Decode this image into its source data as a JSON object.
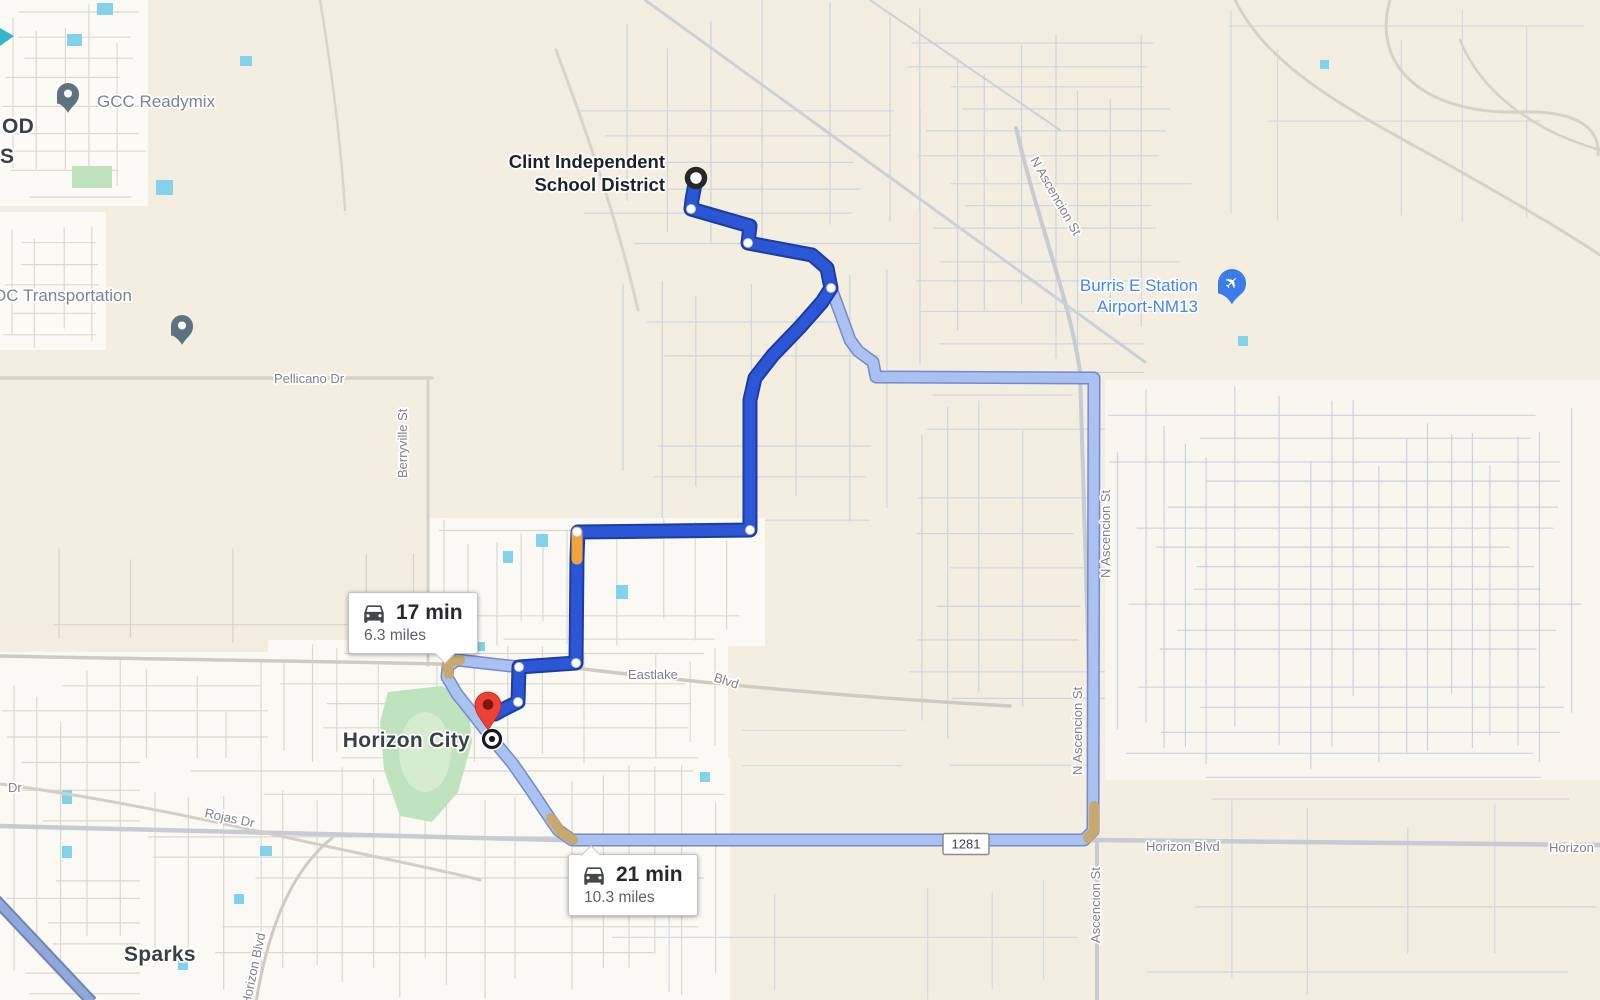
{
  "map": {
    "colors": {
      "bg": "#F3EEDF",
      "urban": "#FBFAF5",
      "urban2": "#F8F6EE",
      "minor_road": "#DCD8CE",
      "minor_road_blue": "#CDD5E2",
      "road_gray": "#C6CBD4",
      "road_warm": "#D6D2C8",
      "water": "#82D2EC",
      "water_dark": "#35B6CE",
      "park": "#BFE3BD",
      "park_light": "#D6ECCF",
      "primary_route": "#2B56D6",
      "primary_casing": "#1C3CA4",
      "alt_route": "#A9C2F2",
      "alt_casing": "#7589CE",
      "traffic_orange": "#F2A43A",
      "traffic_tan": "#C9A86E",
      "highway_blue": "#91A8DB",
      "highway_blue_casing": "#6F83B2",
      "poi_pin": "#5E7282",
      "airport_pin": "#3B7CE8",
      "dest_pin": "#EA4335",
      "dest_pin_dot": "#7E150F"
    }
  },
  "routes": {
    "primary": {
      "width": 11,
      "points": [
        [
          696,
          178
        ],
        [
          692,
          200
        ],
        [
          691,
          209
        ],
        [
          750,
          226
        ],
        [
          748,
          243
        ],
        [
          812,
          255
        ],
        [
          827,
          268
        ],
        [
          831,
          288
        ],
        [
          822,
          302
        ],
        [
          800,
          327
        ],
        [
          773,
          355
        ],
        [
          755,
          378
        ],
        [
          750,
          400
        ],
        [
          750,
          530
        ],
        [
          578,
          532
        ],
        [
          577,
          557
        ],
        [
          576,
          663
        ],
        [
          519,
          667
        ],
        [
          518,
          702
        ],
        [
          506,
          708
        ],
        [
          495,
          714
        ]
      ]
    },
    "alternate": {
      "width": 10,
      "points": [
        [
          519,
          667
        ],
        [
          457,
          660
        ],
        [
          448,
          666
        ],
        [
          447,
          677
        ],
        [
          457,
          694
        ],
        [
          473,
          714
        ],
        [
          493,
          740
        ],
        [
          513,
          764
        ],
        [
          531,
          790
        ],
        [
          547,
          814
        ],
        [
          558,
          830
        ],
        [
          572,
          840
        ],
        [
          1084,
          840
        ],
        [
          1093,
          831
        ],
        [
          1094,
          378
        ],
        [
          876,
          377
        ],
        [
          873,
          362
        ],
        [
          858,
          351
        ],
        [
          850,
          340
        ],
        [
          838,
          307
        ],
        [
          831,
          288
        ]
      ]
    },
    "traffic_orange_segments": [
      [
        [
          577,
          532
        ],
        [
          577,
          559
        ]
      ]
    ],
    "traffic_tan_segments": [
      [
        [
          449,
          674
        ],
        [
          447,
          666
        ],
        [
          452,
          661
        ],
        [
          460,
          660
        ]
      ],
      [
        [
          551,
          818
        ],
        [
          560,
          831
        ],
        [
          573,
          840
        ]
      ],
      [
        [
          1094,
          806
        ],
        [
          1094,
          831
        ],
        [
          1088,
          838
        ]
      ]
    ],
    "waypoints": [
      [
        691,
        209
      ],
      [
        748,
        243
      ],
      [
        831,
        288
      ],
      [
        750,
        530
      ],
      [
        577,
        532
      ],
      [
        576,
        663
      ],
      [
        519,
        667
      ],
      [
        518,
        702
      ]
    ]
  },
  "bubbles": {
    "primary": {
      "duration": "17 min",
      "distance": "6.3 miles",
      "x": 348,
      "y": 592,
      "pointer": "down"
    },
    "alternate": {
      "duration": "21 min",
      "distance": "10.3 miles",
      "x": 568,
      "y": 854,
      "pointer": "up"
    }
  },
  "shield": {
    "text": "1281",
    "x": 966,
    "y": 844
  },
  "markers": {
    "start": {
      "x": 696,
      "y": 178
    },
    "destination": {
      "x": 488,
      "y": 705
    },
    "destination_dot": {
      "x": 492,
      "y": 739
    },
    "pois": [
      {
        "id": "gcc-readymix-pin",
        "x": 68,
        "y": 94,
        "glyph": "dot",
        "color": "#5E7282"
      },
      {
        "id": "dc-transportation-pin",
        "x": 182,
        "y": 326,
        "glyph": "dot",
        "color": "#5E7282"
      },
      {
        "id": "burris-airport-pin",
        "x": 1232,
        "y": 283,
        "glyph": "plane",
        "color": "#3B7CE8"
      }
    ]
  },
  "labels": [
    {
      "text": "OD",
      "x": 2,
      "y": 133,
      "cls": "city"
    },
    {
      "text": "S",
      "x": 0,
      "y": 163,
      "cls": "city"
    },
    {
      "text": "GCC Readymix",
      "x": 97,
      "y": 107,
      "cls": "poi",
      "interact": true
    },
    {
      "text": "DC Transportation",
      "x": -6,
      "y": 301,
      "cls": "poi",
      "interact": true
    },
    {
      "text": "Pellicano Dr",
      "x": 274,
      "y": 383,
      "cls": "road"
    },
    {
      "text": "Berryville St",
      "x": 407,
      "y": 478,
      "cls": "road",
      "rot": -90
    },
    {
      "text": "Clint Independent",
      "x": 665,
      "y": 168,
      "cls": "dest",
      "anchor": "end"
    },
    {
      "text": "School District",
      "x": 665,
      "y": 191,
      "cls": "dest",
      "anchor": "end"
    },
    {
      "text": "Burris E Station",
      "x": 1198,
      "y": 291,
      "cls": "airport",
      "anchor": "end",
      "interact": true
    },
    {
      "text": "Airport-NM13",
      "x": 1198,
      "y": 312,
      "cls": "airport",
      "anchor": "end",
      "interact": true
    },
    {
      "text": "N Ascencion St",
      "x": 1030,
      "y": 160,
      "cls": "road",
      "rot": 60
    },
    {
      "text": "N Ascencion St",
      "x": 1110,
      "y": 578,
      "cls": "road",
      "rot": -90
    },
    {
      "text": "N Ascencion St",
      "x": 1082,
      "y": 775,
      "cls": "road",
      "rot": -90
    },
    {
      "text": "Ascencion St",
      "x": 1100,
      "y": 943,
      "cls": "road",
      "rot": -90
    },
    {
      "text": "Eastlake",
      "x": 628,
      "y": 679,
      "cls": "road"
    },
    {
      "text": "Blvd",
      "x": 713,
      "y": 681,
      "cls": "road",
      "rot": 18
    },
    {
      "text": "Horizon Blvd",
      "x": 1146,
      "y": 851,
      "cls": "road"
    },
    {
      "text": "Horizon",
      "x": 1549,
      "y": 852,
      "cls": "road"
    },
    {
      "text": "Horizon City",
      "x": 470,
      "y": 747,
      "cls": "city",
      "anchor": "end"
    },
    {
      "text": "Rojas Dr",
      "x": 204,
      "y": 817,
      "cls": "road",
      "rot": 12
    },
    {
      "text": "Dr",
      "x": 8,
      "y": 792,
      "cls": "road"
    },
    {
      "text": "Sparks",
      "x": 124,
      "y": 961,
      "cls": "city"
    },
    {
      "text": "Horizon Blvd",
      "x": 250,
      "y": 1006,
      "cls": "road",
      "rot": -78
    }
  ]
}
